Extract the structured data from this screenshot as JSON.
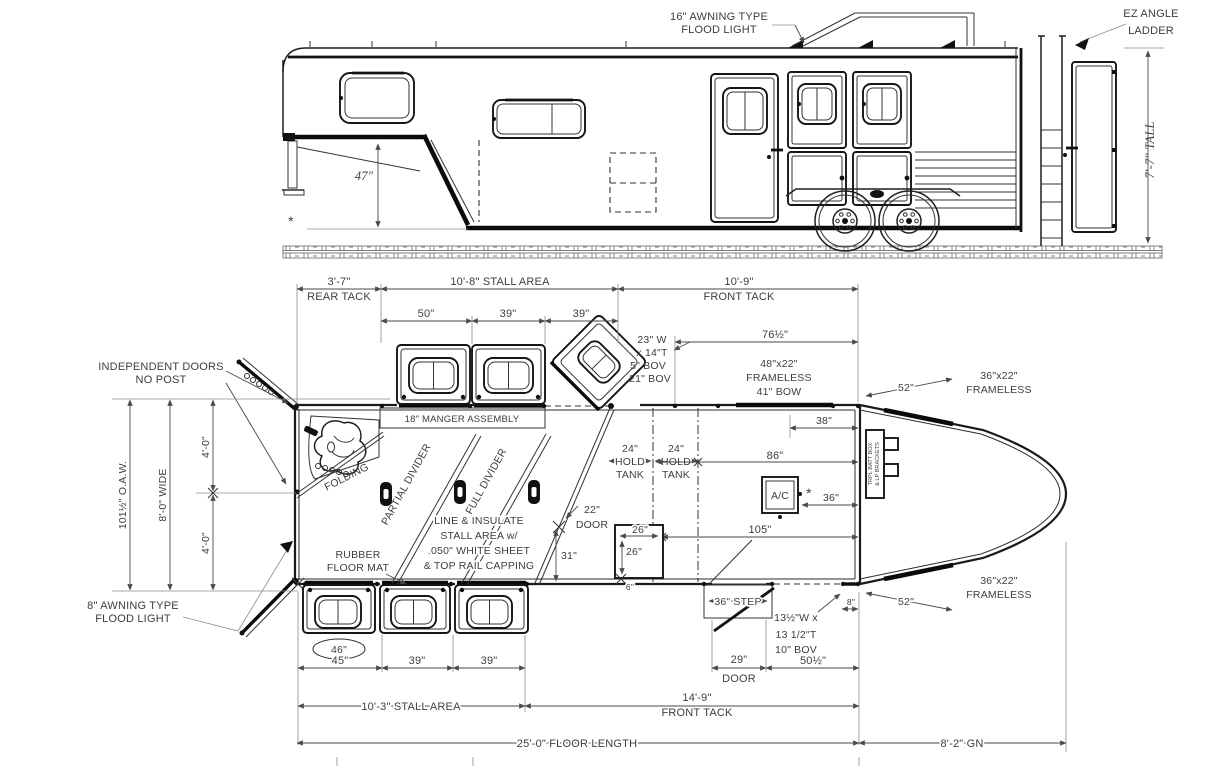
{
  "side": {
    "flood16_1": "16\" AWNING TYPE",
    "flood16_2": "FLOOD LIGHT",
    "ladder_1": "EZ ANGLE",
    "ladder_2": "LADDER",
    "tall": "7'-7\" TALL",
    "gn_height": "47\"",
    "star": "*"
  },
  "plan": {
    "rear_tack_dim": "3'-7\"",
    "rear_tack_lbl": "REAR TACK",
    "stall_area_top": "10'-8\" STALL AREA",
    "front_tack_dim": "10'-9\"",
    "front_tack_lbl": "FRONT TACK",
    "w50": "50\"",
    "w39a": "39\"",
    "w39b": "39\"",
    "rw1": "23\" W",
    "rw2": "x 14\"T",
    "rw3": "5\" BOV",
    "rw4": "21\" BOV",
    "d76": "76½\"",
    "fw1": "48\"x22\"",
    "fw2": "FRAMELESS",
    "fw3": "41\" BOW",
    "ind1": "INDEPENDENT DOORS",
    "ind2": "NO POST",
    "oaw": "101½\" O.A.W.",
    "wide": "8'-0\" WIDE",
    "ft4a": "4'-0\"",
    "ft4b": "4'-0\"",
    "folding": "FOLDING",
    "manger": "18\" MANGER ASSEMBLY",
    "pdiv": "PARTIAL DIVIDER",
    "fdiv": "FULL DIVIDER",
    "ins1": "LINE & INSULATE",
    "ins2": "STALL AREA w/",
    "ins3": ".050\" WHITE SHEET",
    "ins4": "& TOP RAIL CAPPING",
    "d22": "22\"",
    "door22": "DOOR",
    "d31": "31\"",
    "tank1a": "24\"",
    "tank1b": "HOLD",
    "tank1c": "TANK",
    "tank2a": "24\"",
    "tank2b": "HOLD",
    "tank2c": "TANK",
    "d38": "38\"",
    "d86": "86\"",
    "ac": "A/C",
    "star": "*",
    "d36": "36\"",
    "d105": "105\"",
    "batt1": "TRPL BATT BOX",
    "batt2": "& LP BRACKETS",
    "d26a": "26\"",
    "d26b": "26\"",
    "d6": "6\"",
    "step": "36\" STEP",
    "bov1": "13½\"W x",
    "bov2": "13 1/2\"T",
    "bov3": "10\" BOV",
    "d8": "8\"",
    "d29": "29\"",
    "door29": "DOOR",
    "d50": "50½\"",
    "d52t": "52\"",
    "d52b": "52\"",
    "nf1a": "36\"x22\"",
    "nf1b": "FRAMELESS",
    "nf2a": "36\"x22\"",
    "nf2b": "FRAMELESS",
    "rubber1": "RUBBER",
    "rubber2": "FLOOR MAT",
    "flood8_1": "8\" AWNING TYPE",
    "flood8_2": "FLOOD LIGHT",
    "mat46": "46\"",
    "w45": "45\"",
    "w39c": "39\"",
    "w39d": "39\"",
    "stall_area_bot": "10'-3\" STALL AREA",
    "ft149": "14'-9\"",
    "ft_lbl2": "FRONT TACK",
    "floor_len": "25'-0\" FLOOR LENGTH",
    "gn": "8'-2\" GN"
  }
}
